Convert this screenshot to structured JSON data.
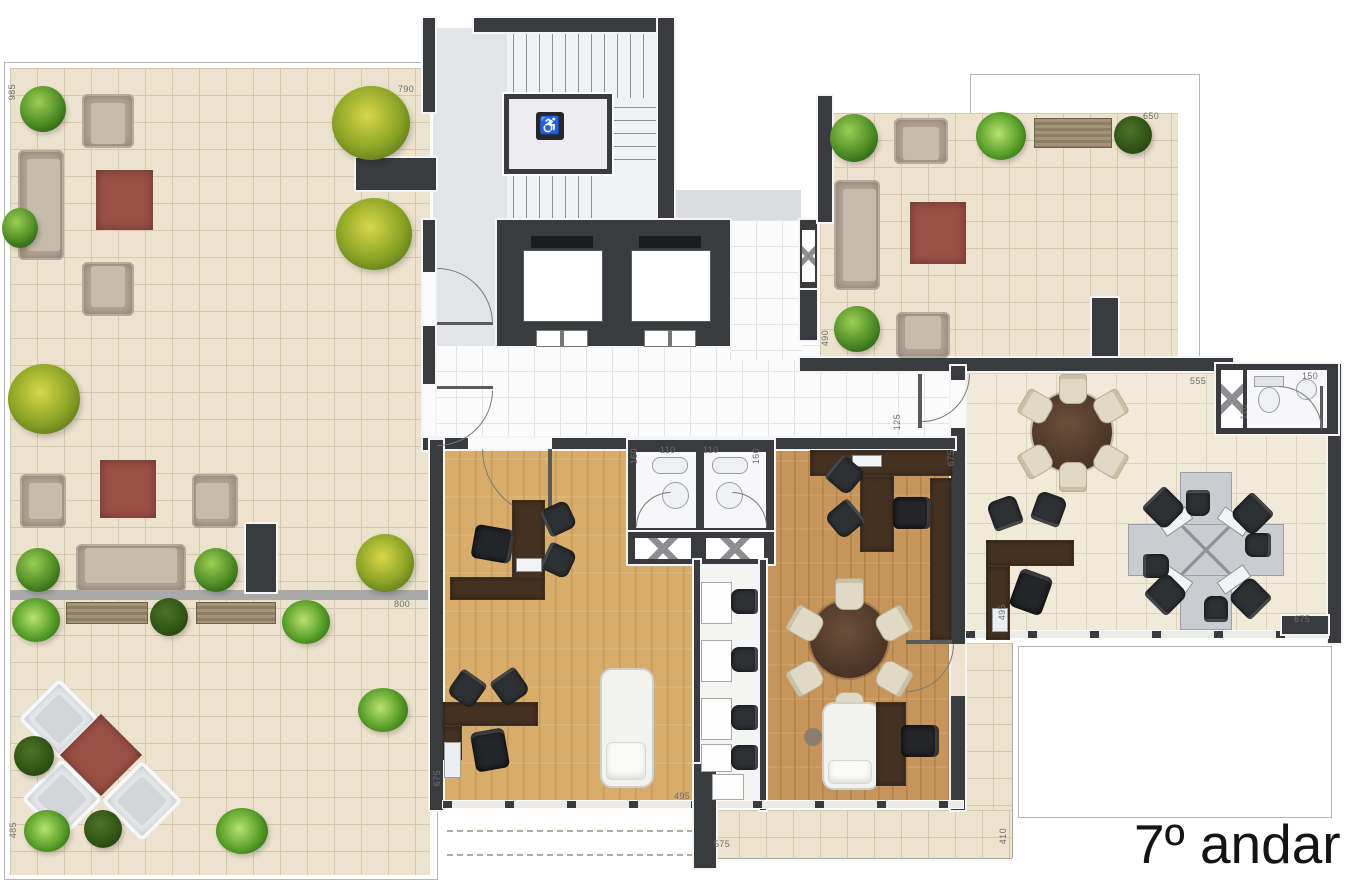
{
  "title": {
    "text": "7º andar"
  },
  "icons": {
    "wheelchair": "♿"
  },
  "colors": {
    "wall": "#3a3b3e",
    "terrace_tile": "#ece2ce",
    "office_tile": "#f1ead9",
    "wood_light": "#d8ad6b",
    "wood_mid": "#c7955a",
    "rug_red": "#9b5046",
    "sofa_tan": "#b2a494",
    "desk_wood": "#443122",
    "workstation_gray": "#c9cdd1"
  },
  "dimension_labels": [
    {
      "text": "985",
      "x": 8,
      "y": 84,
      "v": true
    },
    {
      "text": "790",
      "x": 398,
      "y": 85,
      "v": false
    },
    {
      "text": "650",
      "x": 1143,
      "y": 112,
      "v": false
    },
    {
      "text": "490",
      "x": 821,
      "y": 330,
      "v": true
    },
    {
      "text": "800",
      "x": 394,
      "y": 600,
      "v": false
    },
    {
      "text": "675",
      "x": 433,
      "y": 770,
      "v": true
    },
    {
      "text": "485",
      "x": 9,
      "y": 822,
      "v": true
    },
    {
      "text": "555",
      "x": 1190,
      "y": 377,
      "v": false
    },
    {
      "text": "150",
      "x": 1302,
      "y": 372,
      "v": false
    },
    {
      "text": "110",
      "x": 1240,
      "y": 404,
      "v": true
    },
    {
      "text": "125",
      "x": 893,
      "y": 414,
      "v": true
    },
    {
      "text": "675",
      "x": 947,
      "y": 450,
      "v": true
    },
    {
      "text": "675",
      "x": 1294,
      "y": 615,
      "v": false
    },
    {
      "text": "495",
      "x": 998,
      "y": 604,
      "v": true
    },
    {
      "text": "495",
      "x": 674,
      "y": 792,
      "v": false
    },
    {
      "text": "575",
      "x": 714,
      "y": 840,
      "v": false
    },
    {
      "text": "410",
      "x": 999,
      "y": 828,
      "v": true
    },
    {
      "text": "160",
      "x": 630,
      "y": 448,
      "v": true
    },
    {
      "text": "110",
      "x": 660,
      "y": 446,
      "v": false
    },
    {
      "text": "110",
      "x": 703,
      "y": 446,
      "v": false
    },
    {
      "text": "160",
      "x": 752,
      "y": 448,
      "v": true
    }
  ]
}
